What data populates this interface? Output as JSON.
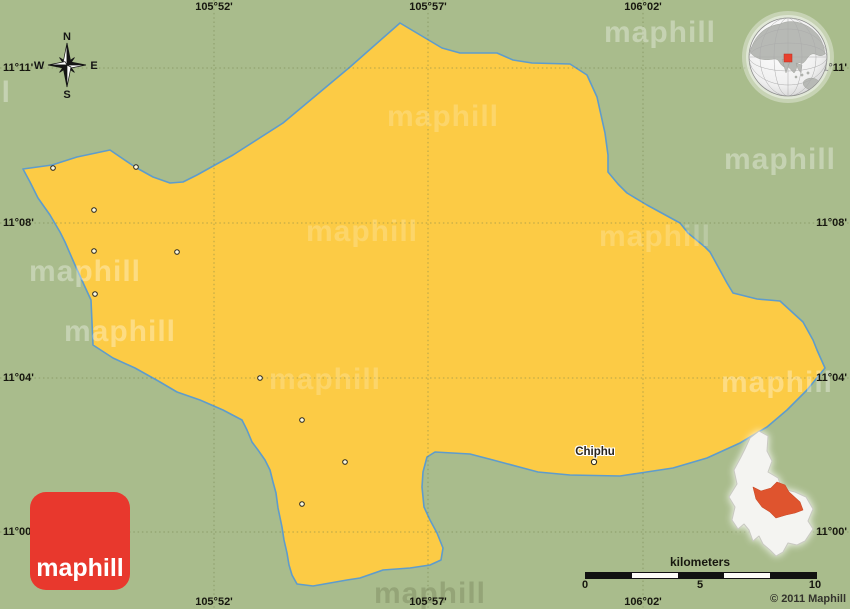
{
  "map": {
    "region_name": "Chiphu",
    "colors": {
      "background_green": "#a9bc8c",
      "area_yellow": "#fccb45",
      "boundary_blue": "#5e9ccc",
      "logo_red": "#e8382d",
      "inset_highlight_orange": "#df542e"
    },
    "grid": {
      "meridians": [
        {
          "label": "105°52'",
          "x": 214
        },
        {
          "label": "105°57'",
          "x": 428
        },
        {
          "label": "106°02'",
          "x": 643
        }
      ],
      "parallels": [
        {
          "label": "11°11'",
          "y": 68
        },
        {
          "label": "11°08'",
          "y": 223
        },
        {
          "label": "11°04'",
          "y": 378
        },
        {
          "label": "11°00'",
          "y": 532
        }
      ]
    },
    "places": [
      {
        "name": "Chiphu",
        "x": 594,
        "y": 462
      }
    ],
    "towns": [
      {
        "x": 53,
        "y": 168
      },
      {
        "x": 136,
        "y": 167
      },
      {
        "x": 94,
        "y": 210
      },
      {
        "x": 94,
        "y": 251
      },
      {
        "x": 177,
        "y": 252
      },
      {
        "x": 95,
        "y": 294
      },
      {
        "x": 260,
        "y": 378
      },
      {
        "x": 302,
        "y": 420
      },
      {
        "x": 345,
        "y": 462
      },
      {
        "x": 302,
        "y": 504
      }
    ]
  },
  "compass": {
    "north": "N",
    "east": "E",
    "south": "S",
    "west": "W"
  },
  "scalebar": {
    "title": "kilometers",
    "ticks": [
      "0",
      "5",
      "10"
    ]
  },
  "watermark": {
    "text": "maphill"
  },
  "logo": {
    "text": "maphill"
  },
  "copyright": "© 2011 Maphill"
}
